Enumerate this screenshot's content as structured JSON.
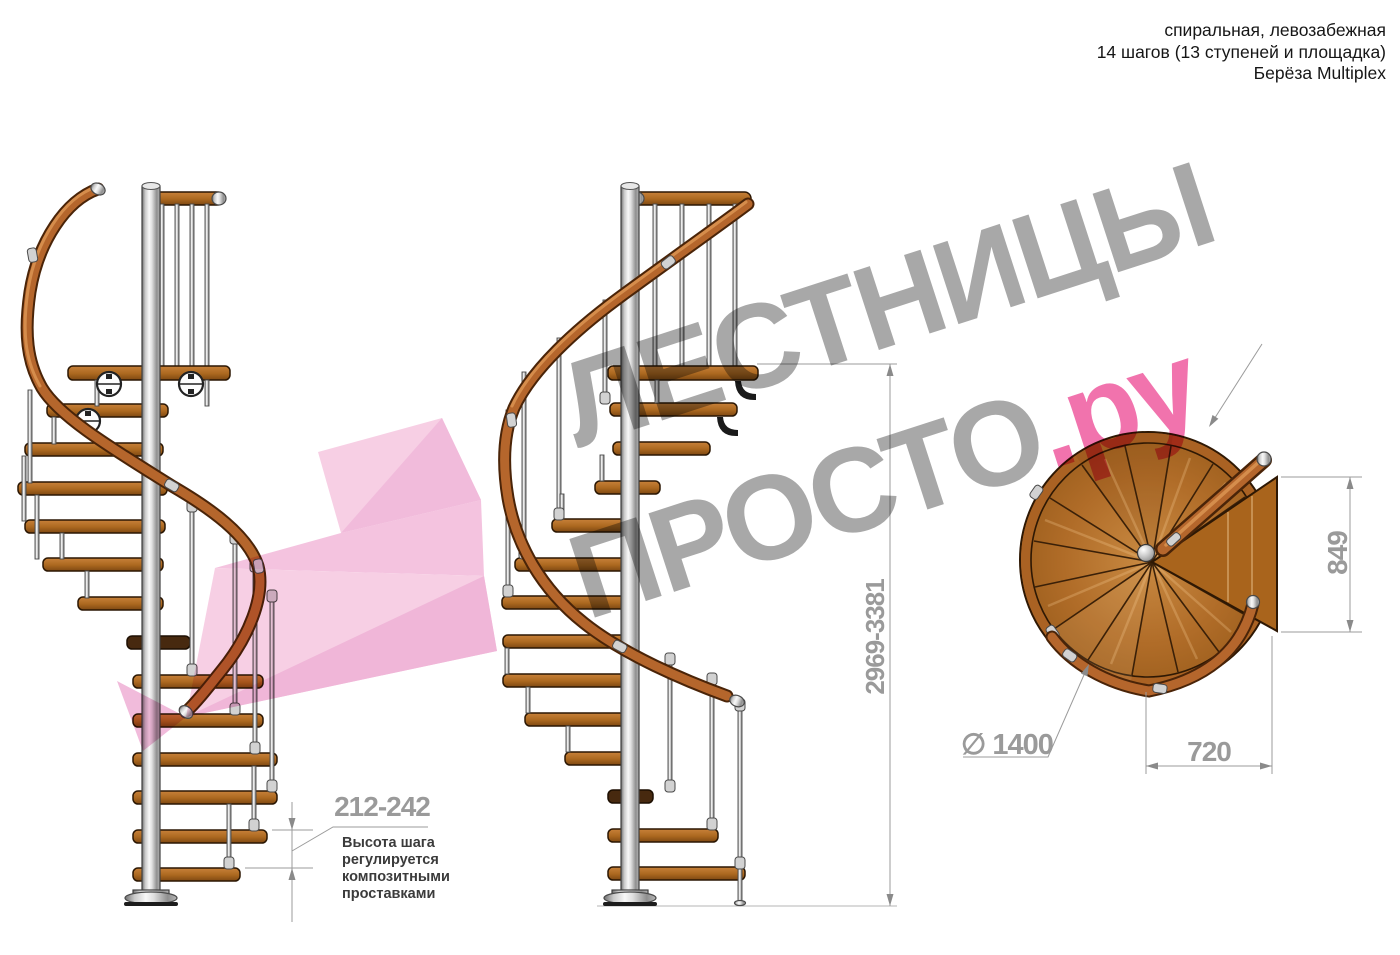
{
  "header": {
    "line1": "спиральная, левозабежная",
    "line2": "14 шагов (13 ступеней и площадка)",
    "line3": "Берёза Multiplex"
  },
  "watermark": {
    "word1": "ЛЕСТНИЦЫ",
    "word2": "ПРОСТО",
    "suffix": ".ру"
  },
  "annotation": {
    "step_height_range": "212-242",
    "note": "Высота шага\nрегулируется\nкомпозитными\nпроставками"
  },
  "dims": {
    "total_height": "2969-3381",
    "landing_depth": "849",
    "step_width": "720",
    "diameter": "∅ 1400"
  },
  "colors": {
    "wood": "#a9671f",
    "handrail": "#b5662c",
    "metal": "#c9c9c9",
    "watermark_gray": "#9c9c9c",
    "watermark_pink": "#ef5fa2",
    "arrow_pink_light": "#f5c3de",
    "arrow_pink_dark": "#eca4ce",
    "dimension_gray": "#9b9b9b"
  }
}
